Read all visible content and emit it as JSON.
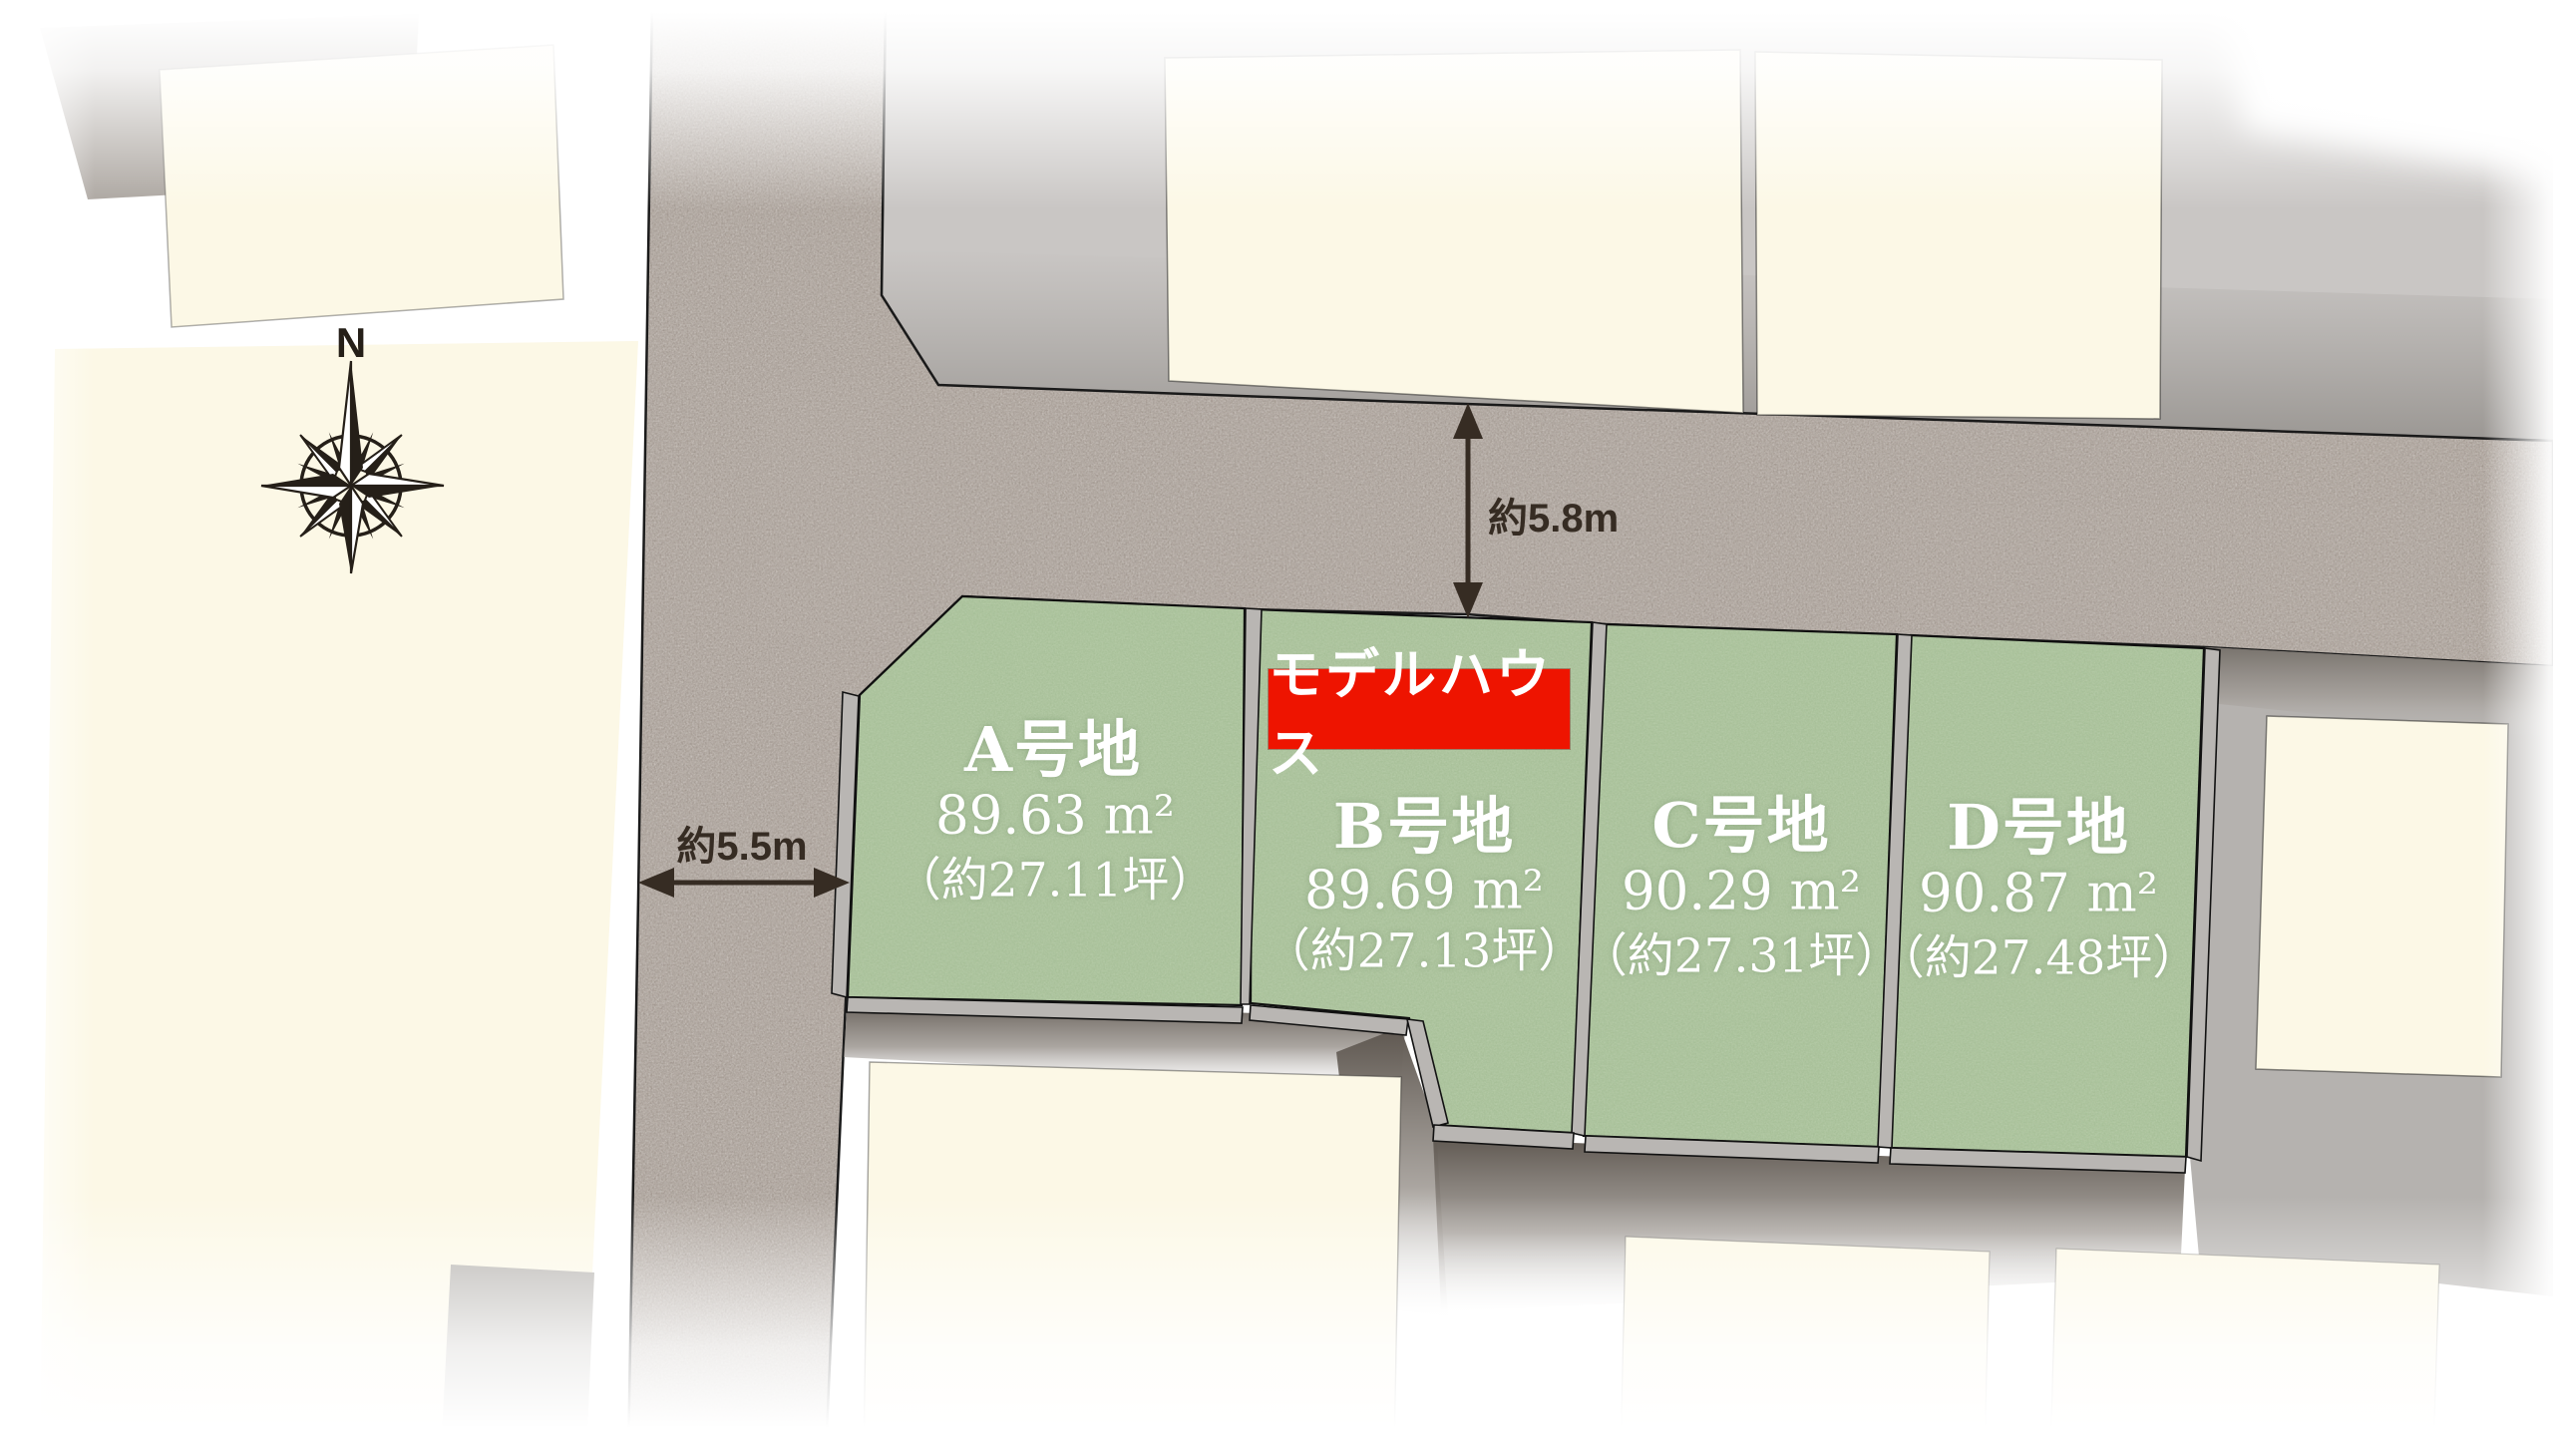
{
  "site_plan": {
    "compass": {
      "north_label": "N"
    },
    "badge": {
      "text": "モデルハウス",
      "color": "#ee1400"
    },
    "lots": [
      {
        "name": "A号地",
        "area_m2": "89.63 m²",
        "area_tsubo": "（約27.11坪）"
      },
      {
        "name": "B号地",
        "area_m2": "89.69 m²",
        "area_tsubo": "（約27.13坪）"
      },
      {
        "name": "C号地",
        "area_m2": "90.29 m²",
        "area_tsubo": "（約27.31坪）"
      },
      {
        "name": "D号地",
        "area_m2": "90.87 m²",
        "area_tsubo": "（約27.48坪）"
      }
    ],
    "annotations": {
      "north_road_width": "約5.8m",
      "west_road_width": "約5.5m"
    },
    "colors": {
      "lot_green": "#a8c099",
      "road_gray": "#a29890",
      "parcel_cream": "#fcf8e6",
      "shadow_gray": "#c9c6c4",
      "badge_red": "#ee1400",
      "outline_black": "#1a1a1a",
      "label_white": "#ffffff",
      "annotation_dark": "#362c23"
    }
  }
}
